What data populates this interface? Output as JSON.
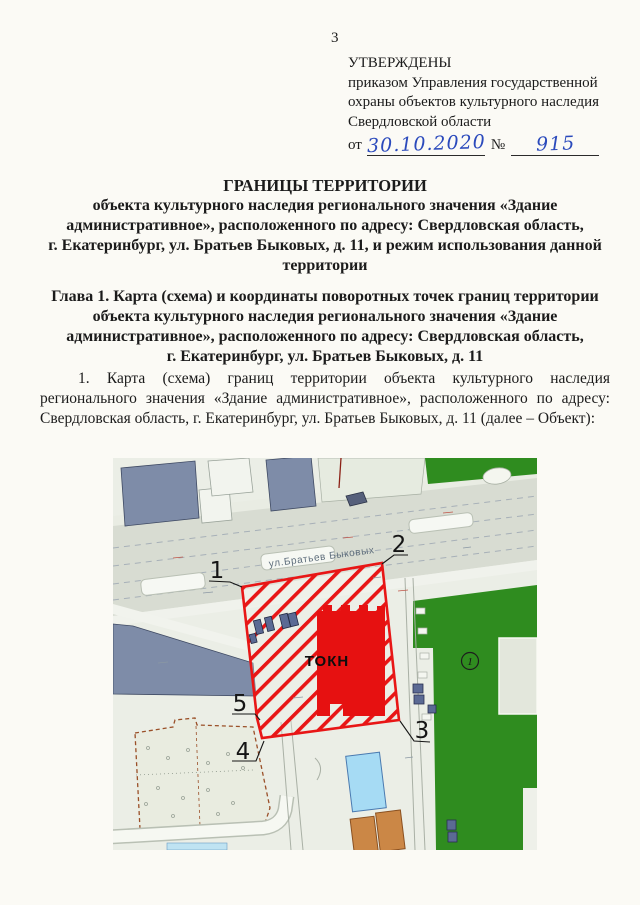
{
  "page": {
    "number": "3"
  },
  "approval": {
    "status": "УТВЕРЖДЕНЫ",
    "line2": "приказом Управления государственной",
    "line3": "охраны объектов культурного наследия",
    "line4": "Свердловской области",
    "from_label": "от",
    "date": "30.10.2020",
    "no_label": "№",
    "order_number": "915"
  },
  "title": {
    "line1": "ГРАНИЦЫ ТЕРРИТОРИИ",
    "line2": "объекта культурного наследия регионального значения «Здание",
    "line3": "административное», расположенного по адресу: Свердловская область,",
    "line4": "г. Екатеринбург, ул. Братьев Быковых, д. 11, и режим использования данной",
    "line5": "территории"
  },
  "chapter": {
    "line1": "Глава 1. Карта (схема) и координаты поворотных точек границ территории",
    "line2": "объекта культурного наследия регионального значения «Здание",
    "line3": "административное», расположенного по адресу: Свердловская область,",
    "line4": "г. Екатеринбург, ул. Братьев Быковых, д. 11"
  },
  "body": {
    "paragraph": "1. Карта (схема) границ территории объекта культурного наследия регионального значения «Здание административное», расположенного по адресу: Свердловская область, г. Екатеринбург, ул. Братьев Быковых, д. 11 (далее – Объект):"
  },
  "map": {
    "street_label": "ул.Братьев Быковых",
    "okn_label": "ТОКН",
    "point_labels": [
      "1",
      "2",
      "3",
      "4",
      "5"
    ],
    "parcel_label": "1",
    "colors": {
      "territory_red": "#e81616",
      "okn_red": "#e61111",
      "green": "#2f8c1f",
      "building_blue": "#7e8ca8",
      "cyan_building": "#a6dbf4",
      "orange_building": "#cb8746",
      "road_gray": "#d8dcd2",
      "handwriting_blue": "#2b4abc"
    }
  }
}
